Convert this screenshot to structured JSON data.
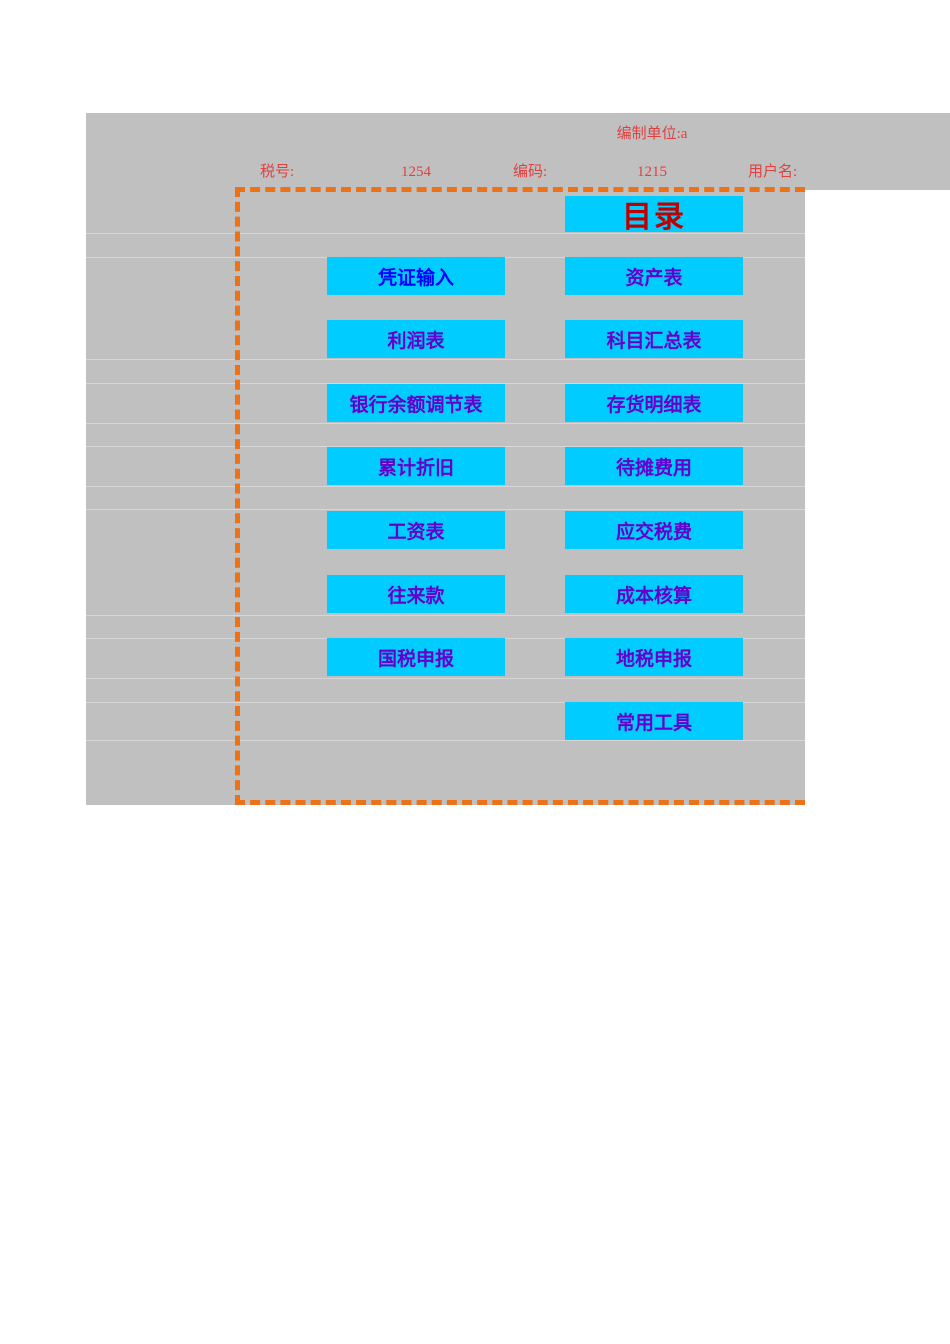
{
  "header": {
    "unit": "编制单位:a",
    "tax_no_label": "税号:",
    "tax_no_value": "1254",
    "code_label": "编码:",
    "code_value": "1215",
    "user_label": "用户名:"
  },
  "menu": {
    "title": "目录",
    "left_buttons": [
      "凭证输入",
      "利润表",
      "银行余额调节表",
      "累计折旧",
      "工资表",
      "往来款",
      "国税申报"
    ],
    "right_buttons": [
      "资产表",
      "科目汇总表",
      "存货明细表",
      "待摊费用",
      "应交税费",
      "成本核算",
      "地税申报",
      "常用工具"
    ]
  },
  "colors": {
    "sheet_gray": "#C0C0C0",
    "gridline_gray": "#D7D7D7",
    "button_cyan": "#00CCFF",
    "link_blue": "#0000FF",
    "link_visited_purple": "#6600CC",
    "title_red": "#C00000",
    "header_red": "#E04040",
    "page_break_orange": "#ED7117"
  }
}
